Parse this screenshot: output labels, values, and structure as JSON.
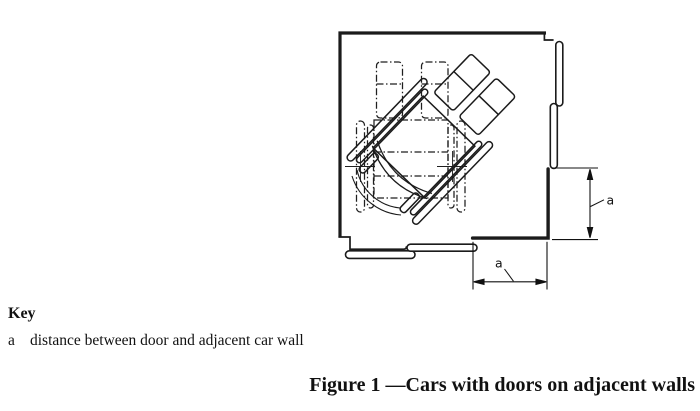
{
  "figure": {
    "dim_right_label": "a",
    "dim_bottom_label": "a",
    "line_color": "#1b1b1b",
    "background": "#ffffff"
  },
  "key": {
    "title": "Key",
    "items": [
      {
        "symbol": "a",
        "text": "distance between door and adjacent car wall"
      }
    ]
  },
  "caption": "Figure 1 —Cars with doors on adjacent walls"
}
